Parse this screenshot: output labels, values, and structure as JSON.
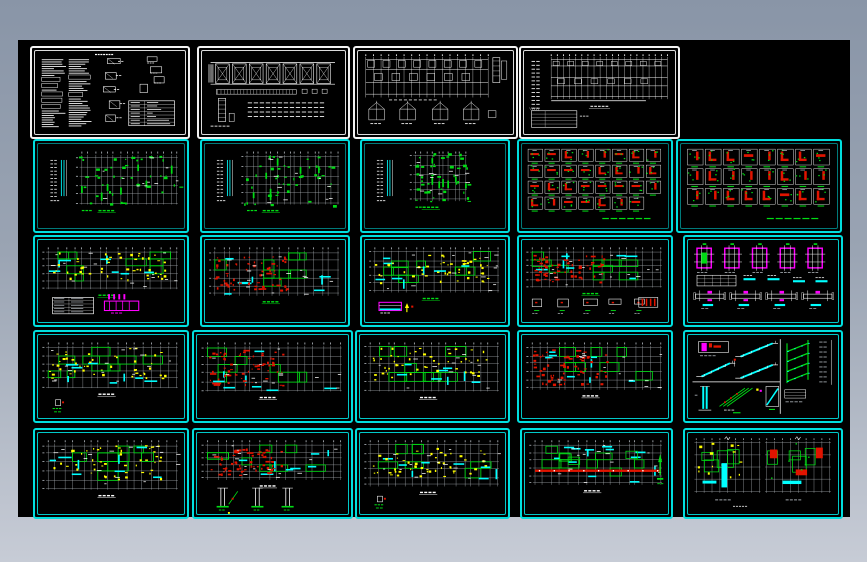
{
  "meta": {
    "description": "Preview mosaic of a residential structural CAD drawing set: 24 sheets arranged in 5 rows on a black model-space background over a blue-grey page",
    "page_bg_top": "#8995a7",
    "page_bg_bottom": "#c7ccd6",
    "canvas_bg": "#000000"
  },
  "palette": {
    "white": "#ffffff",
    "gray": "#aab0b6",
    "cyan": "#00dede",
    "cyan_fill": "#00ffff",
    "green": "#00dc14",
    "red": "#e01400",
    "yellow": "#ffff00",
    "magenta": "#ff00ff"
  },
  "canvas": {
    "x": 18,
    "y": 40,
    "w": 832,
    "h": 477
  },
  "panels": [
    {
      "id": "r1c1",
      "name": "general-notes-sheet",
      "type": "notes_sheet",
      "x": 30,
      "y": 46,
      "w": 156,
      "h": 89,
      "border": "white",
      "seed": 101,
      "cfg": {}
    },
    {
      "id": "r1c2",
      "name": "roof-structure-sheet",
      "type": "truss_plan",
      "x": 197,
      "y": 46,
      "w": 149,
      "h": 89,
      "border": "white",
      "seed": 102,
      "cfg": {}
    },
    {
      "id": "r1c3",
      "name": "foundation-detail-sheet",
      "type": "foundation_plan",
      "x": 353,
      "y": 46,
      "w": 161,
      "h": 89,
      "border": "white",
      "seed": 103,
      "cfg": {}
    },
    {
      "id": "r1c4",
      "name": "foundation-plan-sheet",
      "type": "foundation_plan_b",
      "x": 519,
      "y": 46,
      "w": 157,
      "h": 89,
      "border": "white",
      "seed": 104,
      "cfg": {}
    },
    {
      "id": "r2c1",
      "name": "column-layout-plan-1",
      "type": "floor_plan",
      "x": 33,
      "y": 139,
      "w": 152,
      "h": 90,
      "border": "cyan",
      "seed": 105,
      "cfg": {
        "style": "green_marks",
        "legend": true,
        "cap": "green",
        "pb": 0.7
      }
    },
    {
      "id": "r2c2",
      "name": "column-layout-plan-2",
      "type": "floor_plan",
      "x": 200,
      "y": 139,
      "w": 146,
      "h": 90,
      "border": "cyan",
      "seed": 106,
      "cfg": {
        "style": "green_marks",
        "legend": true,
        "cap": "green",
        "pb": 0.7
      }
    },
    {
      "id": "r2c3",
      "name": "column-layout-plan-3",
      "type": "floor_plan",
      "x": 360,
      "y": 139,
      "w": 146,
      "h": 90,
      "border": "cyan",
      "seed": 107,
      "cfg": {
        "style": "green_marks",
        "legend": true,
        "cap": "green",
        "pb": 0.66,
        "px0": 0.36,
        "px1": 0.72,
        "nv": 10
      }
    },
    {
      "id": "r2c4",
      "name": "column-detail-grid-1",
      "type": "details_grid",
      "x": 517,
      "y": 139,
      "w": 152,
      "h": 90,
      "border": "cyan",
      "seed": 108,
      "cfg": {
        "cols": 8,
        "rows": 4,
        "gh": 0.76,
        "note": true
      }
    },
    {
      "id": "r2c5",
      "name": "column-detail-grid-2",
      "type": "details_grid",
      "x": 676,
      "y": 139,
      "w": 162,
      "h": 90,
      "border": "cyan",
      "seed": 109,
      "cfg": {
        "cols": 8,
        "rows": 3,
        "gh": 0.7,
        "note": true
      }
    },
    {
      "id": "r3c1",
      "name": "beam-plan-1",
      "type": "floor_plan",
      "x": 33,
      "y": 235,
      "w": 152,
      "h": 88,
      "border": "cyan2",
      "seed": 110,
      "cfg": {
        "style": "rooms",
        "dense": "yellow",
        "cap": "green",
        "pb": 0.58,
        "sub": "table_magenta"
      }
    },
    {
      "id": "r3c2",
      "name": "beam-plan-2",
      "type": "floor_plan",
      "x": 200,
      "y": 235,
      "w": 146,
      "h": 88,
      "border": "cyan2",
      "seed": 111,
      "cfg": {
        "style": "rooms",
        "dense": "red",
        "cap": "green",
        "pb": 0.66
      }
    },
    {
      "id": "r3c3",
      "name": "beam-plan-3",
      "type": "floor_plan",
      "x": 360,
      "y": 235,
      "w": 146,
      "h": 88,
      "border": "cyan2",
      "seed": 112,
      "cfg": {
        "style": "rooms",
        "dense": "yellow",
        "cap": "green",
        "pb": 0.62,
        "sub": "magenta_small"
      }
    },
    {
      "id": "r3c4",
      "name": "beam-plan-4",
      "type": "floor_plan",
      "x": 517,
      "y": 235,
      "w": 152,
      "h": 88,
      "border": "cyan2",
      "seed": 113,
      "cfg": {
        "style": "rooms",
        "dense": "red",
        "cap": "green",
        "pb": 0.56,
        "sub": "white_row"
      }
    },
    {
      "id": "r3c5",
      "name": "footing-detail-sheet",
      "type": "column_details",
      "x": 683,
      "y": 235,
      "w": 156,
      "h": 88,
      "border": "cyan2",
      "seed": 114,
      "cfg": {}
    },
    {
      "id": "r4c1",
      "name": "beam-plan-5",
      "type": "floor_plan",
      "x": 33,
      "y": 330,
      "w": 152,
      "h": 89,
      "border": "cyan2",
      "seed": 115,
      "cfg": {
        "style": "rooms",
        "dense": "yellow",
        "cap": "white",
        "pb": 0.62,
        "sub": "tiny_green"
      }
    },
    {
      "id": "r4c2",
      "name": "beam-plan-6",
      "type": "floor_plan",
      "x": 192,
      "y": 330,
      "w": 157,
      "h": 89,
      "border": "cyan2",
      "seed": 116,
      "cfg": {
        "style": "rooms",
        "dense": "red",
        "cap": "white",
        "pb": 0.66
      }
    },
    {
      "id": "r4c3",
      "name": "beam-plan-7",
      "type": "floor_plan",
      "x": 355,
      "y": 330,
      "w": 151,
      "h": 89,
      "border": "cyan2",
      "seed": 117,
      "cfg": {
        "style": "rooms",
        "dense": "yellow",
        "cap": "white",
        "pb": 0.66
      }
    },
    {
      "id": "r4c4",
      "name": "beam-plan-8",
      "type": "floor_plan",
      "x": 517,
      "y": 330,
      "w": 152,
      "h": 89,
      "border": "cyan2",
      "seed": 118,
      "cfg": {
        "style": "rooms",
        "dense": "red",
        "cap": "white",
        "pb": 0.64
      }
    },
    {
      "id": "r4c5",
      "name": "stair-detail-sheet",
      "type": "stair_details",
      "x": 683,
      "y": 330,
      "w": 156,
      "h": 89,
      "border": "cyan2",
      "seed": 119,
      "cfg": {}
    },
    {
      "id": "r5c1",
      "name": "slab-plan-1",
      "type": "floor_plan",
      "x": 33,
      "y": 428,
      "w": 152,
      "h": 87,
      "border": "cyan2",
      "seed": 120,
      "cfg": {
        "style": "rooms",
        "dense": "yellow",
        "cap": "white",
        "pb": 0.68
      }
    },
    {
      "id": "r5c2",
      "name": "slab-plan-2",
      "type": "floor_plan",
      "x": 192,
      "y": 428,
      "w": 157,
      "h": 87,
      "border": "cyan2",
      "seed": 121,
      "cfg": {
        "style": "rooms",
        "dense": "red",
        "cap": "white",
        "pb": 0.56,
        "sub": "stilts"
      }
    },
    {
      "id": "r5c3",
      "name": "slab-plan-3",
      "type": "floor_plan",
      "x": 355,
      "y": 428,
      "w": 151,
      "h": 87,
      "border": "cyan2",
      "seed": 122,
      "cfg": {
        "style": "rooms",
        "dense": "yellow",
        "cap": "white",
        "pb": 0.64,
        "sub": "tiny_green"
      }
    },
    {
      "id": "r5c4",
      "name": "slab-plan-4",
      "type": "floor_plan",
      "x": 520,
      "y": 428,
      "w": 149,
      "h": 87,
      "border": "cyan2",
      "seed": 123,
      "cfg": {
        "style": "rooms",
        "dense": null,
        "red_beam": true,
        "cap": "white",
        "pb": 0.62,
        "sub": "green_arrow"
      }
    },
    {
      "id": "r5c5",
      "name": "roof-plan-sheet",
      "type": "roof_plans",
      "x": 683,
      "y": 428,
      "w": 156,
      "h": 87,
      "border": "cyan2",
      "seed": 124,
      "cfg": {}
    }
  ]
}
